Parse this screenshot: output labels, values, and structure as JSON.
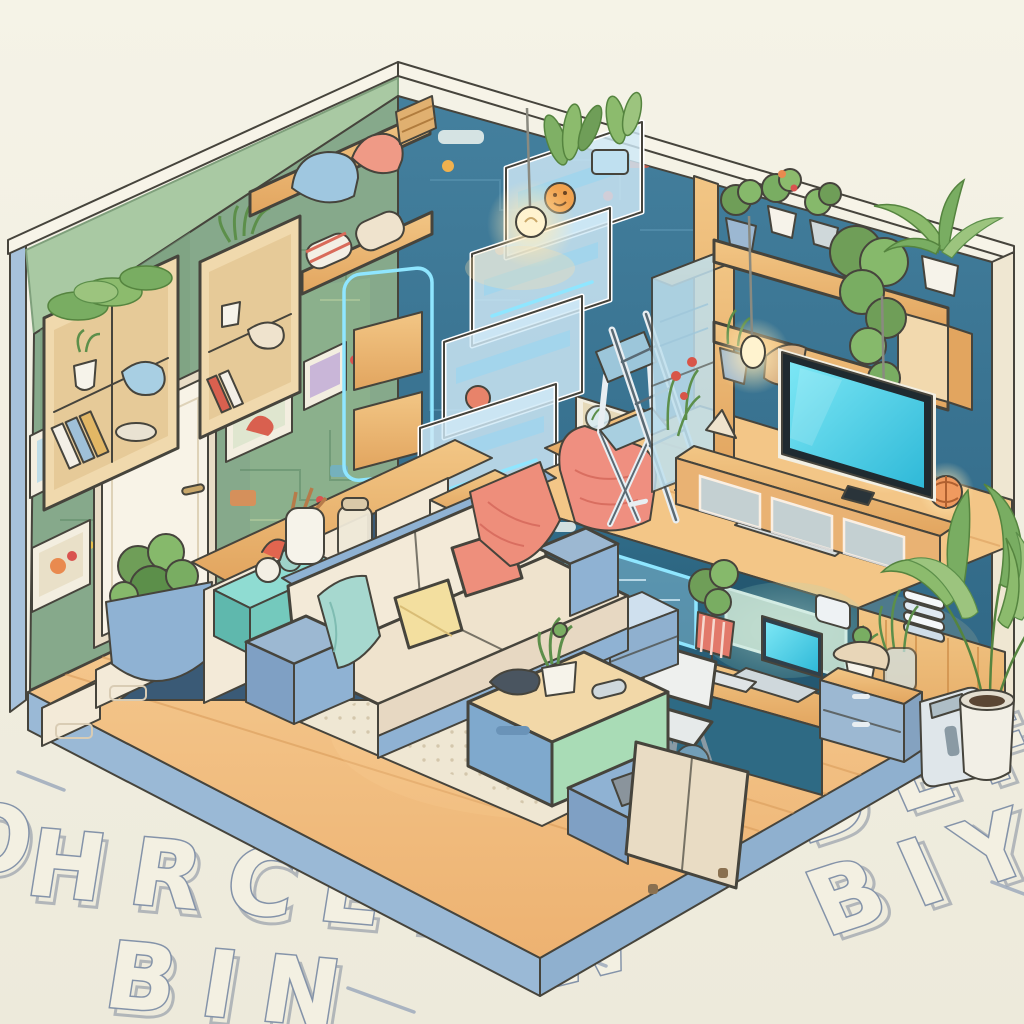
{
  "scene": {
    "title": "Cozy Tech Tiny Home — Isometric Cutaway Illustration",
    "style": "digital illustration, pastel palette, hand-drawn outlines",
    "view": "isometric cutaway of a smart studio apartment on a pale floor with embossed outline letters"
  },
  "palette": {
    "background": "#f2efe3",
    "exterior_sage": "#a9c9a3",
    "plinth_blue": "#93b7d6",
    "wall_left_green": "#86a98b",
    "wall_right_teal": "#3c7795",
    "floor_wood": "#f5c98e",
    "furniture_wood": "#eab573",
    "glass_blue": "#cfe9f7",
    "neon_cyan": "#8fe6ff",
    "sofa_cream": "#f3e9d6",
    "sofa_blue": "#8fb2d3",
    "pillow_yellow": "#f3df9f",
    "pillow_coral": "#ee8f7c",
    "table_mint": "#a9dcb6",
    "screen_cyan": "#49d0e8",
    "lamp_warm": "#ffd98f",
    "letter_outline": "#8493a9",
    "plant_green": "#79ad62"
  },
  "floor_letters": {
    "left_partial": "O",
    "left_row1": "HRCEP",
    "left_row2": "BIN",
    "right_row1": "BDEF",
    "right_row2": "BIY",
    "right_stray": "W"
  },
  "inventory": [
    "wooden storage staircase with drawers",
    "under-stair planter with shrub",
    "white interior door",
    "picture frames on circuit-pattern wall",
    "wall cubby shelves with plants, books and pillows",
    "overhead shelf with bedding and basket",
    "cascading glass smart-shelf stairs with succulents",
    "neon-framed wall panels",
    "loft nook with folding chair, ladder and coral blanket",
    "glass wardrobe cabinet with flowers",
    "hanging filament bulbs",
    "right wall shelf with potted plants and trailing ivy",
    "flat-screen TV with cyan screen on wooden media console",
    "woven orange table lamp",
    "raised platform with circuit-glass front panel",
    "built-in desk nook with laptop, keyboard, mouse and plants",
    "white desk chair",
    "blue drawer units",
    "cream and blue modular sofa with yellow and coral pillows",
    "coral throw blanket",
    "teal cloth",
    "storage coffee table with mint and blue sides",
    "dotted area rug",
    "blue floor mat",
    "beige and blue armchair",
    "tall potted broadleaf plant",
    "portable air purifier",
    "embossed outline letters on the ground"
  ]
}
